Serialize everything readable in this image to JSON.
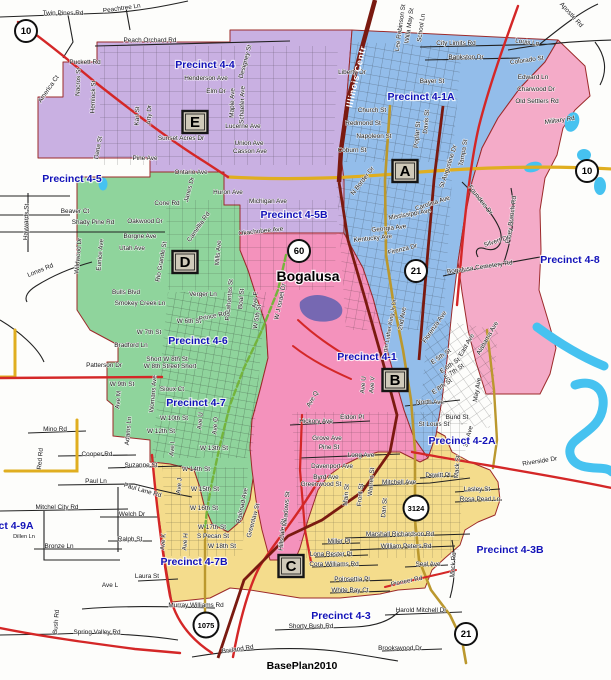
{
  "map": {
    "plan_label": "BasePlan2010",
    "city": "Bogalusa",
    "railroad_label": "Illinois Centr",
    "colors": {
      "purple": "#c9b0e2",
      "blue": "#93bdea",
      "green": "#8fd49c",
      "pink_48": "#f4abc8",
      "pink_41": "#f492bc",
      "yellow": "#f4dc8c",
      "water": "#46c2f0",
      "purple_pond": "#7668b2",
      "road_red": "#d42727",
      "railroad": "#7a1a10",
      "road_yellow": "#e0ae20",
      "road_olive": "#bb982e",
      "road_green": "#74b43c",
      "boundary": "#9c2a2a",
      "precinct_text": "#1212b8",
      "street_text": "#141414",
      "marker_fill": "#cfc9b9",
      "shield_fill": "#ffffff"
    },
    "precinct_labels": [
      {
        "label": "Precinct 4-4",
        "x": 205,
        "y": 68
      },
      {
        "label": "Precinct 4-1A",
        "x": 421,
        "y": 100
      },
      {
        "label": "Precinct 4-5",
        "x": 72,
        "y": 182
      },
      {
        "label": "Precinct 4-5B",
        "x": 294,
        "y": 218
      },
      {
        "label": "Precinct 4-8",
        "x": 570,
        "y": 263
      },
      {
        "label": "Precinct 4-6",
        "x": 198,
        "y": 344
      },
      {
        "label": "Precinct 4-1",
        "x": 367,
        "y": 360
      },
      {
        "label": "Precinct 4-7",
        "x": 196,
        "y": 406
      },
      {
        "label": "Precinct 4-2A",
        "x": 462,
        "y": 444
      },
      {
        "label": "Precinct 4-9",
        "x": -35,
        "y": 313
      },
      {
        "label": "Precinct 4-9A",
        "x": 0,
        "y": 529
      },
      {
        "label": "Precinct 4-7B",
        "x": 194,
        "y": 565
      },
      {
        "label": "Precinct 4-3B",
        "x": 510,
        "y": 553
      },
      {
        "label": "Precinct 4-3",
        "x": 341,
        "y": 619
      }
    ],
    "markers": [
      {
        "letter": "E",
        "x": 195,
        "y": 122
      },
      {
        "letter": "A",
        "x": 405,
        "y": 171
      },
      {
        "letter": "D",
        "x": 185,
        "y": 262
      },
      {
        "letter": "B",
        "x": 395,
        "y": 380
      },
      {
        "letter": "C",
        "x": 291,
        "y": 566
      }
    ],
    "shields": [
      {
        "num": "10",
        "x": 26,
        "y": 31
      },
      {
        "num": "10",
        "x": 587,
        "y": 171
      },
      {
        "num": "60",
        "x": 299,
        "y": 251
      },
      {
        "num": "21",
        "x": 416,
        "y": 271
      },
      {
        "num": "3124",
        "x": 416,
        "y": 508
      },
      {
        "num": "1075",
        "x": 206,
        "y": 625
      },
      {
        "num": "21",
        "x": 466,
        "y": 634
      }
    ],
    "streets": [
      {
        "t": "Twin Pines Rd",
        "x": 63,
        "y": 15
      },
      {
        "t": "Peachtree Ln",
        "x": 122,
        "y": 10,
        "r": -8
      },
      {
        "t": "Peach Orchard Rd",
        "x": 150,
        "y": 42
      },
      {
        "t": "Puckett Rd",
        "x": 85,
        "y": 64
      },
      {
        "t": "America Ct",
        "x": 50,
        "y": 90,
        "r": -55
      },
      {
        "t": "Nacros St",
        "x": 80,
        "y": 82,
        "r": -88
      },
      {
        "t": "Hemlock St",
        "x": 95,
        "y": 97,
        "r": -88
      },
      {
        "t": "Designey St",
        "x": 247,
        "y": 62,
        "r": -75
      },
      {
        "t": "Henderson Ave",
        "x": 206,
        "y": 80
      },
      {
        "t": "Elm Dr",
        "x": 216,
        "y": 93
      },
      {
        "t": "Dana St",
        "x": 100,
        "y": 148,
        "r": -80
      },
      {
        "t": "Karl St",
        "x": 139,
        "y": 116,
        "r": -88
      },
      {
        "t": "Arty Dr",
        "x": 151,
        "y": 115,
        "r": -88
      },
      {
        "t": "Maple Ave",
        "x": 234,
        "y": 103,
        "r": -88
      },
      {
        "t": "Schaefer Ave",
        "x": 244,
        "y": 105,
        "r": -88
      },
      {
        "t": "Lucerne Ave",
        "x": 243,
        "y": 128
      },
      {
        "t": "Sunset Acres Dr",
        "x": 181,
        "y": 140
      },
      {
        "t": "Union Ave",
        "x": 249,
        "y": 145
      },
      {
        "t": "Casson Ave",
        "x": 250,
        "y": 153
      },
      {
        "t": "Pine Ave",
        "x": 145,
        "y": 160
      },
      {
        "t": "Ontario Ave",
        "x": 191,
        "y": 174
      },
      {
        "t": "Huron Ave",
        "x": 228,
        "y": 194
      },
      {
        "t": "Michigan Ave",
        "x": 268,
        "y": 203
      },
      {
        "t": "Cone Rd",
        "x": 167,
        "y": 205
      },
      {
        "t": "Janes Dr",
        "x": 191,
        "y": 190,
        "r": -75
      },
      {
        "t": "Beaver Ct",
        "x": 75,
        "y": 213
      },
      {
        "t": "Shady Pine Rd",
        "x": 93,
        "y": 224
      },
      {
        "t": "Oakwood Dr",
        "x": 145,
        "y": 223
      },
      {
        "t": "Borgne Ave",
        "x": 140,
        "y": 238
      },
      {
        "t": "Utah Ave",
        "x": 132,
        "y": 250
      },
      {
        "t": "Lones Rd",
        "x": 41,
        "y": 272,
        "r": -22
      },
      {
        "t": "Haywards St",
        "x": 28,
        "y": 222,
        "r": -88
      },
      {
        "t": "Wildwood Dr",
        "x": 80,
        "y": 256,
        "r": -85
      },
      {
        "t": "Eunice Ave",
        "x": 102,
        "y": 255,
        "r": -85
      },
      {
        "t": "Rio Grande St",
        "x": 163,
        "y": 262,
        "r": -80
      },
      {
        "t": "Camellia Rd",
        "x": 200,
        "y": 228,
        "r": -55
      },
      {
        "t": "Mills Ave",
        "x": 220,
        "y": 253,
        "r": -85
      },
      {
        "t": "Okachobee Ave",
        "x": 261,
        "y": 233,
        "r": -6
      },
      {
        "t": "Verger Ln",
        "x": 203,
        "y": 296
      },
      {
        "t": "Pocahontas St",
        "x": 231,
        "y": 300,
        "r": -85
      },
      {
        "t": "Boal St",
        "x": 243,
        "y": 299,
        "r": -85
      },
      {
        "t": "Ave F",
        "x": 257,
        "y": 300,
        "r": -85
      },
      {
        "t": "W J Israel Dr",
        "x": 282,
        "y": 302,
        "r": -78
      },
      {
        "t": "Bulls Blvd",
        "x": 126,
        "y": 294
      },
      {
        "t": "Smokey Creek Ln",
        "x": 140,
        "y": 305
      },
      {
        "t": "W 6th St",
        "x": 189,
        "y": 323
      },
      {
        "t": "W 7th St",
        "x": 149,
        "y": 334
      },
      {
        "t": "Bradford Ln",
        "x": 131,
        "y": 347
      },
      {
        "t": "Short W 8th St",
        "x": 167,
        "y": 361
      },
      {
        "t": "W 8th Street Short",
        "x": 170,
        "y": 368
      },
      {
        "t": "Patterson Dr",
        "x": 104,
        "y": 367
      },
      {
        "t": "W 9th St",
        "x": 122,
        "y": 386
      },
      {
        "t": "Sioux Ct",
        "x": 172,
        "y": 391
      },
      {
        "t": "Prince Rd",
        "x": 213,
        "y": 318,
        "r": -12
      },
      {
        "t": "W 5th St",
        "x": 259,
        "y": 317,
        "r": -80
      },
      {
        "t": "Ave M",
        "x": 120,
        "y": 400,
        "r": -85
      },
      {
        "t": "Womans Ave",
        "x": 155,
        "y": 394,
        "r": -85
      },
      {
        "t": "Adams Ln",
        "x": 130,
        "y": 431,
        "r": -85
      },
      {
        "t": "W 10th St",
        "x": 174,
        "y": 420
      },
      {
        "t": "W 12th St",
        "x": 161,
        "y": 433
      },
      {
        "t": "W 13th St",
        "x": 214,
        "y": 450
      },
      {
        "t": "W 14th St",
        "x": 196,
        "y": 471
      },
      {
        "t": "W 15th St",
        "x": 205,
        "y": 491
      },
      {
        "t": "W 16th St",
        "x": 204,
        "y": 510
      },
      {
        "t": "W 17th St",
        "x": 212,
        "y": 529
      },
      {
        "t": "S Pecan St",
        "x": 213,
        "y": 538
      },
      {
        "t": "W 18th St",
        "x": 222,
        "y": 548
      },
      {
        "t": "Ave U",
        "x": 202,
        "y": 421,
        "r": -85
      },
      {
        "t": "Ave O",
        "x": 217,
        "y": 426,
        "r": -85
      },
      {
        "t": "Ave I",
        "x": 174,
        "y": 449,
        "r": -85
      },
      {
        "t": "Ave J",
        "x": 181,
        "y": 486,
        "r": -85
      },
      {
        "t": "Ave K",
        "x": 165,
        "y": 542,
        "r": -85
      },
      {
        "t": "Ave H",
        "x": 187,
        "y": 542,
        "r": -85
      },
      {
        "t": "Railroad Ave",
        "x": 244,
        "y": 506,
        "r": -78
      },
      {
        "t": "Greenlaw St",
        "x": 255,
        "y": 521,
        "r": -75
      },
      {
        "t": "Hillsdale St",
        "x": 284,
        "y": 535,
        "r": -85
      },
      {
        "t": "Mino Rd",
        "x": 55,
        "y": 431
      },
      {
        "t": "Cooper Rd",
        "x": 97,
        "y": 456
      },
      {
        "t": "Suzanne St",
        "x": 141,
        "y": 467
      },
      {
        "t": "Paul Ln",
        "x": 96,
        "y": 483
      },
      {
        "t": "Paul Lane Rd",
        "x": 142,
        "y": 492,
        "r": 16
      },
      {
        "t": "Mitchel City Rd",
        "x": 57,
        "y": 509
      },
      {
        "t": "Welch Dr",
        "x": 132,
        "y": 516
      },
      {
        "t": "Ralph St",
        "x": 130,
        "y": 541
      },
      {
        "t": "Bronze Ln",
        "x": 59,
        "y": 548
      },
      {
        "t": "Dillen Ln",
        "x": 24,
        "y": 538,
        "s": 5.6
      },
      {
        "t": "Red Rd",
        "x": 42,
        "y": 459,
        "r": -85
      },
      {
        "t": "Laura St",
        "x": 147,
        "y": 578
      },
      {
        "t": "Ave L",
        "x": 110,
        "y": 587
      },
      {
        "t": "Murray Williams Rd",
        "x": 196,
        "y": 607
      },
      {
        "t": "Miller Pl",
        "x": 339,
        "y": 543
      },
      {
        "t": "Lona Rester Pl",
        "x": 331,
        "y": 556
      },
      {
        "t": "Cora Williams Rd",
        "x": 334,
        "y": 566
      },
      {
        "t": "Poinsettia Pl",
        "x": 352,
        "y": 581
      },
      {
        "t": "White Bay Ct",
        "x": 350,
        "y": 592
      },
      {
        "t": "Shorty Bush Rd",
        "x": 311,
        "y": 628
      },
      {
        "t": "Breland Rd",
        "x": 238,
        "y": 651,
        "r": -8
      },
      {
        "t": "Spring Valley Rd",
        "x": 97,
        "y": 634
      },
      {
        "t": "Bush Rd",
        "x": 58,
        "y": 622,
        "r": -85
      },
      {
        "t": "Harold Mitchell Dr",
        "x": 421,
        "y": 612
      },
      {
        "t": "Brookswood Dr",
        "x": 400,
        "y": 650
      },
      {
        "t": "Pioneer Rd",
        "x": 407,
        "y": 583,
        "r": -12
      },
      {
        "t": "Seal Ave",
        "x": 428,
        "y": 566
      },
      {
        "t": "William Peters Rd",
        "x": 406,
        "y": 548
      },
      {
        "t": "Marshall Richardson Rd",
        "x": 400,
        "y": 536
      },
      {
        "t": "Mock Rd",
        "x": 455,
        "y": 565,
        "r": -85
      },
      {
        "t": "Mitchell Ave",
        "x": 399,
        "y": 484
      },
      {
        "t": "Dewitt Pl",
        "x": 438,
        "y": 477
      },
      {
        "t": "Lasley St",
        "x": 477,
        "y": 491
      },
      {
        "t": "Rosa Pearl Ln",
        "x": 480,
        "y": 501
      },
      {
        "t": "Riverside Dr",
        "x": 540,
        "y": 463,
        "r": -9
      },
      {
        "t": "Long Ave",
        "x": 361,
        "y": 457
      },
      {
        "t": "Pine St",
        "x": 329,
        "y": 449
      },
      {
        "t": "Grove Ave",
        "x": 327,
        "y": 440
      },
      {
        "t": "Eldon Pl",
        "x": 352,
        "y": 419
      },
      {
        "t": "Hickory Ave",
        "x": 316,
        "y": 423
      },
      {
        "t": "Davenport Ave",
        "x": 332,
        "y": 468
      },
      {
        "t": "Byrd Ave",
        "x": 326,
        "y": 479
      },
      {
        "t": "Greenwood St",
        "x": 321,
        "y": 486
      },
      {
        "t": "Warren St",
        "x": 373,
        "y": 482,
        "r": -85
      },
      {
        "t": "Main St",
        "x": 348,
        "y": 495,
        "r": -85
      },
      {
        "t": "Front St",
        "x": 362,
        "y": 495,
        "r": -85
      },
      {
        "t": "Dan St",
        "x": 386,
        "y": 508,
        "r": -85
      },
      {
        "t": "Meadows St",
        "x": 288,
        "y": 509,
        "r": -85
      },
      {
        "t": "North Ave",
        "x": 430,
        "y": 404
      },
      {
        "t": "Bund St",
        "x": 457,
        "y": 419
      },
      {
        "t": "St Louis St",
        "x": 434,
        "y": 426
      },
      {
        "t": "E 5th St",
        "x": 442,
        "y": 358,
        "r": -35
      },
      {
        "t": "E 6th St",
        "x": 451,
        "y": 367,
        "r": -35
      },
      {
        "t": "E 7th St",
        "x": 455,
        "y": 373,
        "r": -35
      },
      {
        "t": "E 8th St",
        "x": 443,
        "y": 388,
        "r": -35
      },
      {
        "t": "East Ave",
        "x": 468,
        "y": 346,
        "r": -60
      },
      {
        "t": "May Ave",
        "x": 479,
        "y": 390,
        "r": -80
      },
      {
        "t": "Alabama Ave",
        "x": 489,
        "y": 339,
        "r": -60
      },
      {
        "t": "Florenza Ave",
        "x": 436,
        "y": 328,
        "r": -55
      },
      {
        "t": "2nd Ave",
        "x": 404,
        "y": 319,
        "r": -80
      },
      {
        "t": "Martin Luther King Jr Dr",
        "x": 391,
        "y": 330,
        "r": -80,
        "s": 5.8
      },
      {
        "t": "3rd Ave",
        "x": 470,
        "y": 437,
        "r": -75
      },
      {
        "t": "Mack St",
        "x": 459,
        "y": 467,
        "r": -85
      },
      {
        "t": "Ave Q",
        "x": 314,
        "y": 400,
        "r": -60
      },
      {
        "t": "Ave U",
        "x": 365,
        "y": 385,
        "r": -85
      },
      {
        "t": "Ave V",
        "x": 374,
        "y": 385,
        "r": -85
      },
      {
        "t": "Mississippi Ave",
        "x": 410,
        "y": 216,
        "r": -10
      },
      {
        "t": "Carolina Ave",
        "x": 433,
        "y": 205,
        "r": -18
      },
      {
        "t": "Georgia Ave",
        "x": 389,
        "y": 230,
        "r": -6
      },
      {
        "t": "Kentucky Ave",
        "x": 373,
        "y": 240,
        "r": -6
      },
      {
        "t": "Firenza Dr",
        "x": 403,
        "y": 251,
        "r": -14
      },
      {
        "t": "Founders Dr",
        "x": 479,
        "y": 201,
        "r": 52
      },
      {
        "t": "Piney Branch Rd",
        "x": 513,
        "y": 220,
        "r": -82
      },
      {
        "t": "Silvert Dr",
        "x": 497,
        "y": 243,
        "r": -18
      },
      {
        "t": "Bogalusa Cemetery Rd",
        "x": 480,
        "y": 269,
        "r": -8
      },
      {
        "t": "Louis Ln",
        "x": 527,
        "y": 44,
        "r": 8
      },
      {
        "t": "Apostle Rd",
        "x": 570,
        "y": 16,
        "r": 48
      },
      {
        "t": "City Limits Rd",
        "x": 456,
        "y": 45
      },
      {
        "t": "Bankston Dr",
        "x": 466,
        "y": 59
      },
      {
        "t": "Colorado St",
        "x": 527,
        "y": 62,
        "r": -8
      },
      {
        "t": "Edward Ln",
        "x": 533,
        "y": 79
      },
      {
        "t": "Charwood Dr",
        "x": 536,
        "y": 91
      },
      {
        "t": "Old Settlers Rd",
        "x": 537,
        "y": 103
      },
      {
        "t": "Military Rd",
        "x": 560,
        "y": 122,
        "r": -8
      },
      {
        "t": "Liberty Dr",
        "x": 352,
        "y": 74
      },
      {
        "t": "Bayer St",
        "x": 432,
        "y": 83
      },
      {
        "t": "Church St",
        "x": 372,
        "y": 112
      },
      {
        "t": "Redmond St",
        "x": 363,
        "y": 125
      },
      {
        "t": "Napoleon St",
        "x": 374,
        "y": 138
      },
      {
        "t": "Coburn St",
        "x": 352,
        "y": 152
      },
      {
        "t": "Willa May St",
        "x": 411,
        "y": 26,
        "r": -82
      },
      {
        "t": "Lee Robinson St",
        "x": 402,
        "y": 28,
        "r": -82
      },
      {
        "t": "School Ln",
        "x": 423,
        "y": 28,
        "r": -82
      },
      {
        "t": "Poplar St",
        "x": 419,
        "y": 135,
        "r": -85
      },
      {
        "t": "Davis St",
        "x": 428,
        "y": 122,
        "r": -85
      },
      {
        "t": "St Augustine Dr",
        "x": 450,
        "y": 167,
        "r": -72
      },
      {
        "t": "Tampa St",
        "x": 465,
        "y": 153,
        "r": -80
      },
      {
        "t": "N Border Dr",
        "x": 364,
        "y": 182,
        "r": -52
      }
    ]
  }
}
